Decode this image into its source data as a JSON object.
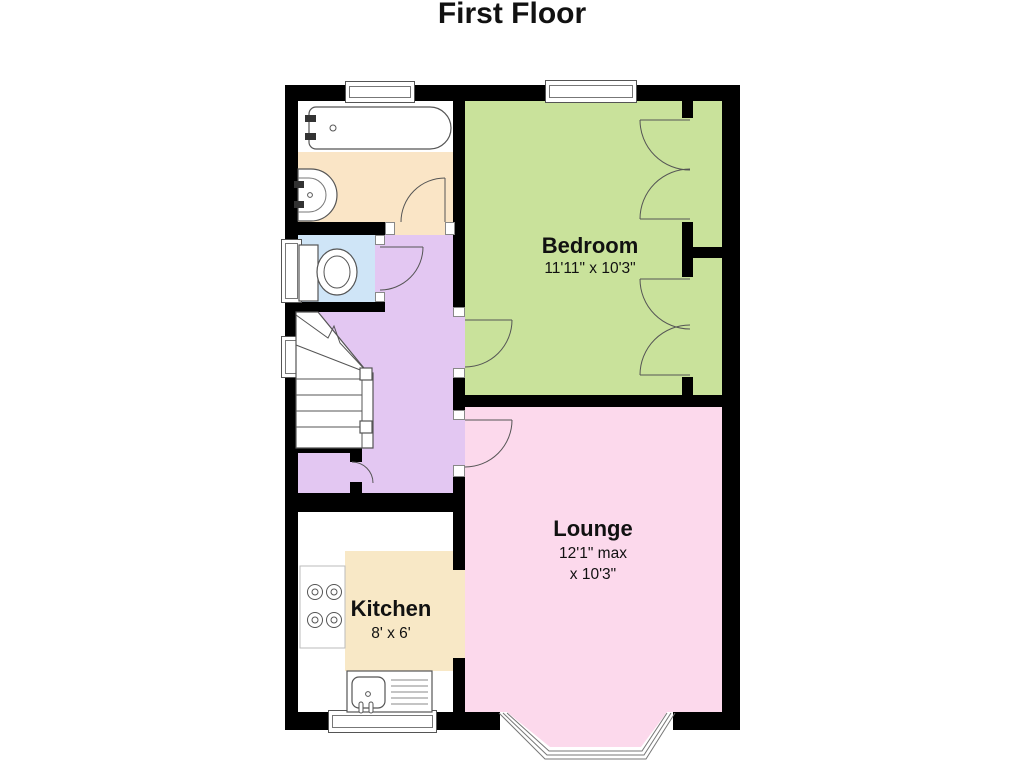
{
  "title": "First Floor",
  "rooms": {
    "bedroom": {
      "name": "Bedroom",
      "dims": "11'11\" x 10'3\"",
      "color": "#c9e29b"
    },
    "lounge": {
      "name": "Lounge",
      "dims_line1": "12'1\" max",
      "dims_line2": "x 10'3\"",
      "color": "#fcd9ec"
    },
    "kitchen": {
      "name": "Kitchen",
      "dims": "8' x 6'",
      "color": "#ffffff",
      "unit_color": "#f8e8c6"
    },
    "hallway": {
      "color": "#e3c7f2"
    },
    "wc": {
      "color": "#cfe5f7"
    },
    "bathroom": {
      "color": "#fae5c6"
    }
  },
  "colors": {
    "wall": "#000000",
    "fixture_outline": "#555555",
    "background": "#ffffff"
  },
  "fixtures": [
    "bathtub",
    "wash-basin",
    "toilet",
    "staircase",
    "under-stairs-cupboard",
    "hob",
    "kitchen-sink",
    "bay-window",
    "built-in-wardrobes"
  ]
}
